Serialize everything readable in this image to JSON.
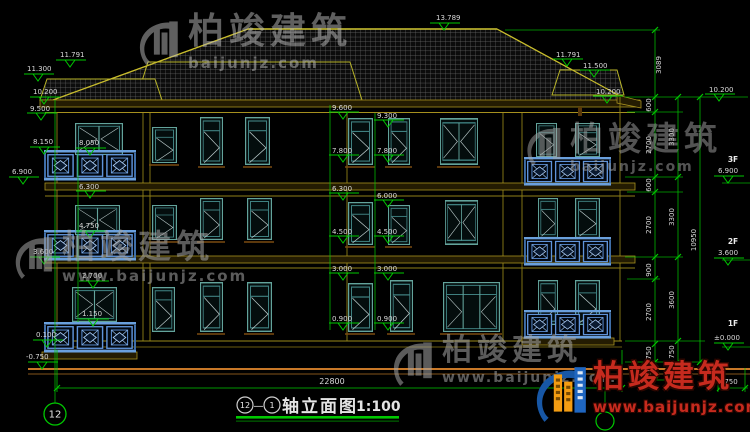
{
  "title": {
    "bubble_left": "12",
    "separator": "—",
    "bubble_right": "1",
    "name": "轴立面图",
    "scale": "1:100"
  },
  "axis_bubbles": {
    "bottom_left": "12"
  },
  "dimensions": {
    "total_width": "22800",
    "right_inner": [
      "600",
      "2700",
      "600",
      "2700",
      "900",
      "2700",
      "750",
      "750"
    ],
    "right_middle": [
      "3300",
      "3300",
      "3600",
      "750",
      "750"
    ],
    "right_overall": "10950",
    "roof_height": "3089",
    "ground_step": "750"
  },
  "levels": {
    "peak": "13.789",
    "left": [
      "11.791",
      "11.300",
      "10.200",
      "9.500",
      "8.150",
      "6.900",
      "3.600",
      "0.100",
      "-0.750"
    ],
    "inner_left": [
      "8.050",
      "6.300",
      "4.750",
      "2.700",
      "1.150"
    ],
    "center": [
      "9.600",
      "9.300",
      "7.800",
      "7.800",
      "6.300",
      "6.000",
      "4.500",
      "4.500",
      "3.000",
      "3.000",
      "0.900",
      "0.900"
    ],
    "right_roof": [
      "11.791",
      "11.500",
      "10.200"
    ],
    "far_right_top": "10.200",
    "floors": [
      {
        "label": "3F",
        "value": "6.900"
      },
      {
        "label": "2F",
        "value": "3.600"
      },
      {
        "label": "1F",
        "value": "±0.000"
      }
    ]
  },
  "watermark": {
    "brand": "柏竣建筑",
    "url": "www.baijunjz.com",
    "url_short": "baijunjz.com"
  },
  "logo": {
    "brand": "柏竣建筑",
    "url": "www.baijunjz.com"
  },
  "colors": {
    "dimension_green": "#00c800",
    "text_white": "#d9d9d9",
    "wall_yellow": "#9a8a1a",
    "window_teal": "#63a39b",
    "railing_blue": "#5f93d9",
    "ground_orange": "#c87828",
    "logo_red": "#c62a1e",
    "logo_blue": "#1757a6",
    "logo_orange": "#f39c12"
  }
}
